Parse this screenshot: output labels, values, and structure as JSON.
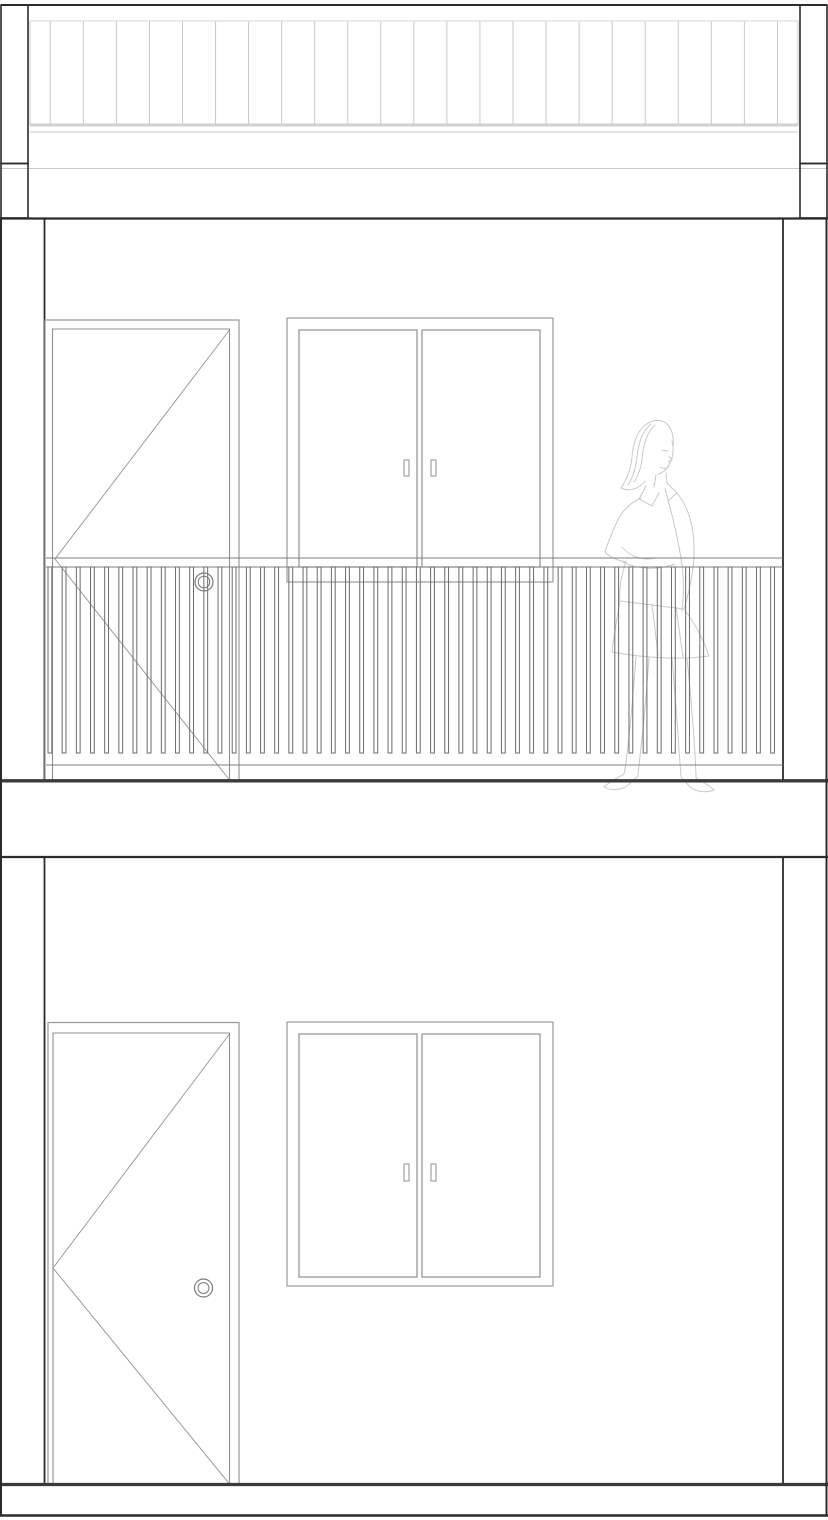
{
  "meta": {
    "title": "Two-storey building elevation drawing",
    "kind": "architectural-elevation",
    "elements": [
      "roof-band",
      "upper-storey",
      "balcony-railing",
      "upper-door",
      "upper-sliding-window",
      "human-figure",
      "floor-slab",
      "lower-storey",
      "lower-door",
      "lower-sliding-window",
      "base-slab"
    ]
  },
  "canvas": {
    "width": 828,
    "height": 1520,
    "background": "#ffffff"
  },
  "palette": {
    "structure": "#2b2b2b",
    "slab": "#3a3a3a",
    "fixture": "#8f8f8f",
    "frame": "#9a9a9a",
    "swing": "#9c9c9c",
    "rail": "#7d7d7d",
    "baluster": "#6b6b6b",
    "knob": "#7a7a7a",
    "roof_line": "#c9c9c9",
    "roof_fascia": "#d0d0d0",
    "roof_top": "#d4d4d4",
    "figure": "#c6caca",
    "handle_fill": "#ffffff"
  },
  "roof_band": {
    "top_line_y": 5,
    "bottom_line_y": 218.5,
    "pilaster_boxes": [
      [
        1,
        5,
        27,
        158.5
      ],
      [
        1,
        163.5,
        27,
        54.5
      ],
      [
        800,
        5,
        27,
        158.5
      ],
      [
        800,
        163.5,
        27,
        54.5
      ]
    ],
    "siding": {
      "x_first": 50.3,
      "spacing": 33.05,
      "count": 23,
      "y_top": 21,
      "y_bottom": 125,
      "left_edge_x": 30,
      "right_edge_x": 798
    },
    "fascia_thick_y": 125,
    "trim_line1_y": 132,
    "trim_line2_y": 168.5
  },
  "outline": {
    "left_x": 1,
    "right_x": 826.5,
    "y_top": 218.5,
    "y_bottom": 1515.5
  },
  "upper_storey": {
    "ceiling_y": 218.5,
    "floor_y": 780.8,
    "wall_left_x": 44.5,
    "wall_right_x": 783,
    "door": {
      "outer": [
        45,
        320,
        194,
        461
      ],
      "inner": [
        52.5,
        329,
        177,
        452
      ],
      "swing": [
        [
          229.5,
          330
        ],
        [
          55,
          559
        ],
        [
          229.5,
          780
        ]
      ],
      "knob": {
        "cx": 204,
        "cy": 582,
        "r_outer": 9,
        "r_inner": 5.8
      }
    },
    "window": {
      "outer": [
        287,
        318,
        266,
        264
      ],
      "sashes": [
        [
          299,
          330,
          118,
          237
        ],
        [
          422,
          330,
          118,
          237
        ]
      ],
      "handles": [
        [
          404,
          460,
          5,
          16
        ],
        [
          431,
          460,
          5,
          16
        ]
      ]
    },
    "railing": {
      "x_start": 46,
      "x_end": 783,
      "top_rail_y1": 558,
      "top_rail_y2": 567,
      "baluster_x_first": 48,
      "baluster_spacing": 14.17,
      "baluster_count": 52,
      "baluster_width": 3.8,
      "baluster_y_top": 567,
      "baluster_y_bottom": 753,
      "bottom_rail_y": 765
    },
    "figure": {
      "paths": [
        "M647,424 C637,430 633,444 632,457 C631,469 627,479 621,488 C629,492 639,489 645,481",
        "M651,424 C642,431 638,445 637,457 C636,468 633,477 628,485",
        "M655,425 C646,433 643,447 642,459 C641,469 638,476 634,482",
        "M647,424 C653,419 663,419 668,425 C672,430 674,438 673,447",
        "M672,441 C674,449 673,457 670,463 C667,469 663,473 658,474",
        "M662,450 l6,1",
        "M669,456 l3,4 l-4,2",
        "M660,467 c3,2 7,2 9,-1",
        "M656,475 L654,487",
        "M666,473 L667,483",
        "M646,486 L639,499 L652,506 L659,493",
        "M667,483 L677,493 L668,501",
        "M641,498 C630,503 621,512 616,524 C611,535 607,545 605,552 C611,558 619,561 626,562",
        "M626,562 C621,576 619,589 620,601",
        "M677,493 C685,503 691,517 693,533 C695,549 694,565 691,580 C689,592 686,602 684,609",
        "M665,489 C671,510 677,534 681,558 C684,577 684,595 682,611",
        "M622,547 C630,557 643,561 655,558",
        "M623,562 C638,570 659,570 675,564",
        "M620,601 L684,609",
        "M620,601 C617,618 614,636 612,652",
        "M684,609 C694,622 703,638 709,656",
        "M612,652 C644,658 680,660 709,656",
        "M652,604 L658,655",
        "M676,607 L683,657",
        "M636,657 C634,682 632,710 629,736 C627,754 626,766 624,774",
        "M649,658 C647,684 645,712 642,738 C640,756 639,766 638,775",
        "M687,659 C690,684 692,712 694,738 C695,756 696,768 696,778",
        "M672,658 C674,682 676,708 678,734 C679,752 680,764 681,776",
        "M624,774 C616,779 608,783 604,787 C611,791 621,790 627,786 L638,776",
        "M696,778 C703,782 710,786 714,790 C706,793 696,792 690,787 L681,777"
      ]
    }
  },
  "floor_slab": {
    "top_y": 780.8,
    "bottom_y": 857
  },
  "lower_storey": {
    "ceiling_y": 857,
    "floor_y": 1484.5,
    "wall_left_x": 44.5,
    "wall_right_x": 783,
    "door": {
      "outer": [
        48,
        1022.5,
        191,
        462
      ],
      "inner": [
        53,
        1033,
        176.5,
        451.5
      ],
      "swing": [
        [
          229.5,
          1034
        ],
        [
          53,
          1268
        ],
        [
          229.5,
          1484
        ]
      ],
      "knob": {
        "cx": 203.5,
        "cy": 1288,
        "r_outer": 9,
        "r_inner": 5.5
      }
    },
    "window": {
      "outer": [
        287,
        1022,
        266,
        264
      ],
      "sashes": [
        [
          299,
          1034,
          118,
          243
        ],
        [
          422,
          1034,
          118,
          243
        ]
      ],
      "handles": [
        [
          404,
          1164,
          5,
          17
        ],
        [
          431,
          1164,
          5,
          17
        ]
      ]
    }
  },
  "base_slab": {
    "top_y": 1484.5,
    "bottom_y": 1515.5
  }
}
